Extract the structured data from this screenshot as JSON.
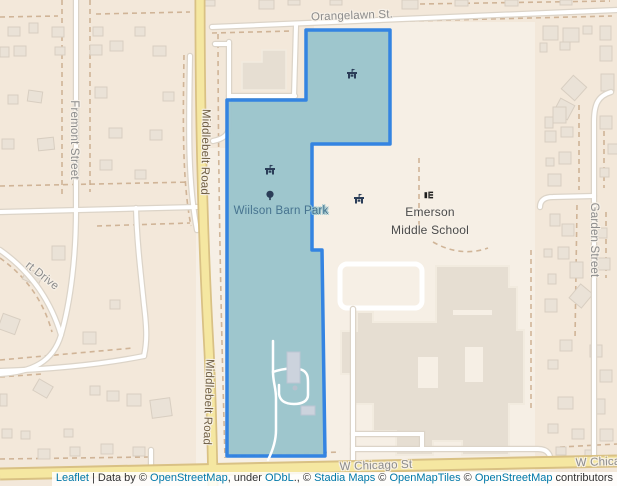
{
  "map": {
    "width": 617,
    "height": 486,
    "colors": {
      "base": "#f6efe5",
      "residential": "#f3e8da",
      "road_casing": "#dcd4c8",
      "road_fill": "#ffffff",
      "major_fill": "#f5e7a1",
      "major_casing": "#d9c184",
      "fence": "#c9aa8b",
      "house_fill": "#eae2d7",
      "house_stroke": "#d8cec1",
      "building_fill": "#e6ded2",
      "building_stroke": "#f2ebdf",
      "courtyard_fill": "#f6efe5",
      "park_fill": "#9cc5cd",
      "park_stroke": "#2e81e2",
      "barn_fill": "#ccd3dd",
      "icon_navy": "#2b3d58",
      "icon_black": "#1d1d1d",
      "label_gray": "#8c8c8c",
      "label_road_brown": "#6f5e44",
      "label_park": "#47738f",
      "label_poi": "#4a4a4a",
      "link_blue": "#0078a8"
    },
    "landuse": [
      {
        "x": 0,
        "y": 0,
        "w": 196,
        "h": 486
      },
      {
        "x": 196,
        "y": 0,
        "w": 118,
        "h": 148
      },
      {
        "x": 535,
        "y": 0,
        "w": 82,
        "h": 486
      },
      {
        "x": 314,
        "y": 0,
        "w": 221,
        "h": 22
      }
    ],
    "dashed_lines": [
      "M 62,0 L 62,198",
      "M 90,0 L 90,192",
      "M 0,186 L 192,182",
      "M 97,226 L 190,223",
      "M 0,17 L 58,16",
      "M 96,14 L 190,12",
      "M 184,55 C 183,120 182,180 191,226",
      "M 218,25 C 218,200 222,350 225,458",
      "M 212,33 L 293,31",
      "M 410,21 L 612,16",
      "M 420,4 L 610,1",
      "M 531,250 L 531,412",
      "M 419,158 L 419,237",
      "M 433,242 C 452,253 472,254 488,248",
      "M 579,105 L 579,190",
      "M 577,205 L 575,340",
      "M 604,122 L 604,188",
      "M 606,212 L 606,278",
      "M 0,360 L 133,348",
      "M 0,377 L 42,374",
      "M 0,258 C 28,278 44,303 52,332",
      "M 0,459 L 148,457",
      "M 232,456 L 340,452",
      "M 560,447 L 617,444"
    ],
    "houses": [
      [
        8,
        27,
        12,
        9,
        0
      ],
      [
        29,
        23,
        9,
        10,
        0
      ],
      [
        52,
        27,
        12,
        10,
        0
      ],
      [
        93,
        27,
        10,
        9,
        0
      ],
      [
        110,
        41,
        13,
        10,
        0
      ],
      [
        135,
        27,
        10,
        9,
        0
      ],
      [
        153,
        46,
        13,
        10,
        0
      ],
      [
        90,
        45,
        12,
        10,
        0
      ],
      [
        55,
        47,
        10,
        8,
        0
      ],
      [
        0,
        47,
        9,
        10,
        0
      ],
      [
        14,
        46,
        12,
        10,
        0
      ],
      [
        95,
        87,
        12,
        11,
        0
      ],
      [
        28,
        91,
        14,
        11,
        8
      ],
      [
        2,
        139,
        12,
        10,
        0
      ],
      [
        38,
        138,
        16,
        12,
        -6
      ],
      [
        109,
        128,
        13,
        10,
        0
      ],
      [
        150,
        130,
        12,
        10,
        0
      ],
      [
        100,
        160,
        12,
        10,
        0
      ],
      [
        135,
        170,
        11,
        9,
        0
      ],
      [
        163,
        92,
        11,
        9,
        0
      ],
      [
        8,
        95,
        10,
        9,
        0
      ],
      [
        52,
        246,
        13,
        14,
        0
      ],
      [
        24,
        271,
        17,
        12,
        25
      ],
      [
        0,
        316,
        18,
        16,
        20
      ],
      [
        83,
        332,
        13,
        12,
        0
      ],
      [
        110,
        300,
        10,
        9,
        0
      ],
      [
        35,
        382,
        16,
        13,
        30
      ],
      [
        90,
        386,
        10,
        9,
        0
      ],
      [
        107,
        391,
        12,
        10,
        0
      ],
      [
        127,
        394,
        14,
        12,
        0
      ],
      [
        151,
        399,
        20,
        18,
        -8
      ],
      [
        0,
        394,
        7,
        12,
        0
      ],
      [
        2,
        429,
        10,
        9,
        0
      ],
      [
        21,
        431,
        9,
        8,
        0
      ],
      [
        38,
        449,
        12,
        10,
        0
      ],
      [
        64,
        429,
        9,
        8,
        0
      ],
      [
        70,
        447,
        10,
        9,
        0
      ],
      [
        101,
        444,
        12,
        10,
        0
      ],
      [
        133,
        447,
        12,
        9,
        0
      ],
      [
        205,
        0,
        10,
        6,
        0
      ],
      [
        259,
        0,
        15,
        9,
        0
      ],
      [
        288,
        0,
        12,
        5,
        0
      ],
      [
        330,
        0,
        12,
        5,
        0
      ],
      [
        402,
        0,
        16,
        9,
        0
      ],
      [
        455,
        0,
        13,
        6,
        0
      ],
      [
        505,
        0,
        13,
        6,
        0
      ],
      [
        560,
        0,
        12,
        5,
        0
      ],
      [
        543,
        26,
        15,
        14,
        0
      ],
      [
        563,
        28,
        16,
        14,
        0
      ],
      [
        583,
        26,
        9,
        8,
        0
      ],
      [
        540,
        43,
        7,
        9,
        0
      ],
      [
        560,
        42,
        10,
        8,
        0
      ],
      [
        600,
        26,
        11,
        14,
        0
      ],
      [
        600,
        46,
        12,
        15,
        0
      ],
      [
        601,
        74,
        13,
        17,
        0
      ],
      [
        565,
        79,
        18,
        18,
        42
      ],
      [
        556,
        101,
        16,
        16,
        28
      ],
      [
        545,
        117,
        8,
        11,
        0
      ],
      [
        553,
        107,
        13,
        16,
        0
      ],
      [
        545,
        131,
        11,
        11,
        0
      ],
      [
        561,
        127,
        12,
        10,
        0
      ],
      [
        546,
        158,
        8,
        8,
        0
      ],
      [
        559,
        152,
        12,
        12,
        0
      ],
      [
        548,
        174,
        13,
        12,
        0
      ],
      [
        600,
        116,
        12,
        13,
        0
      ],
      [
        608,
        144,
        10,
        10,
        0
      ],
      [
        600,
        168,
        9,
        9,
        0
      ],
      [
        550,
        214,
        10,
        12,
        0
      ],
      [
        562,
        224,
        12,
        12,
        0
      ],
      [
        544,
        249,
        8,
        8,
        0
      ],
      [
        558,
        247,
        11,
        12,
        0
      ],
      [
        570,
        262,
        13,
        16,
        0
      ],
      [
        548,
        274,
        8,
        10,
        0
      ],
      [
        598,
        228,
        9,
        10,
        0
      ],
      [
        598,
        258,
        12,
        12,
        0
      ],
      [
        573,
        287,
        16,
        18,
        40
      ],
      [
        545,
        299,
        12,
        13,
        0
      ],
      [
        560,
        340,
        12,
        11,
        0
      ],
      [
        590,
        345,
        12,
        12,
        0
      ],
      [
        548,
        360,
        10,
        9,
        0
      ],
      [
        600,
        370,
        12,
        12,
        0
      ],
      [
        558,
        397,
        15,
        12,
        0
      ],
      [
        592,
        399,
        13,
        15,
        0
      ],
      [
        548,
        424,
        10,
        9,
        0
      ],
      [
        572,
        429,
        12,
        10,
        0
      ],
      [
        600,
        429,
        13,
        12,
        0
      ],
      [
        556,
        447,
        10,
        8,
        0
      ],
      [
        585,
        450,
        11,
        8,
        0
      ]
    ],
    "block_buildings": [
      "242,62 262,62 262,50 286,50 286,90 242,90"
    ],
    "school_building": {
      "outline": "436,266 509,266 509,287 517,287 517,330 524,330 524,404 509,404 509,455 462,455 462,441 433,441 433,455 396,455 396,431 373,431 373,404 352,404 352,374 341,374 341,331 357,331 357,312 373,312 373,322 436,322",
      "courtyards": [
        [
          418,
          357,
          20,
          31
        ],
        [
          465,
          347,
          18,
          35
        ],
        [
          453,
          310,
          39,
          5
        ]
      ]
    },
    "track": {
      "x": 340,
      "y": 264,
      "w": 82,
      "h": 44,
      "rx": 7
    },
    "roads_minor": [
      "M 212,27 L 617,10",
      "M 215,44 L 229,44",
      "M 229,42 L 229,126 C 229,135 223,139 213,141",
      "M 296,26 L 294,96",
      "M 229,96 L 295,96",
      "M 190,56 C 189,120 187,178 197,230",
      "M 0,212 L 197,207",
      "M 76,0 L 76,210",
      "M 76,210 C 76,255 71,300 61,335 C 53,362 32,372 0,374",
      "M 0,250 C 34,274 52,305 61,335",
      "M 136,208 C 137,244 141,275 144,305 C 147,330 147,342 144,356",
      "M 144,356 C 104,364 56,369 0,371",
      "M 151,450 L 151,470",
      "M 611,92 C 598,96 594,104 594,122 L 594,462",
      "M 540,207 C 540,200 545,197 553,197 L 594,196",
      "M 353,309 L 353,463",
      "M 353,434 L 422,434 L 422,449",
      "M 353,449 L 538,449 C 549,449 551,456 551,464"
    ],
    "roads_major": [
      "M 200,0 C 200,140 204,260 209,350 C 211,392 212,432 213,486",
      "M 0,474 L 617,461"
    ],
    "park": {
      "name": "Wiilson Barn Park",
      "outline": "306,30 390,30 390,144 312,144 312,250 322,250 325,456 227,456 227,100 306,100",
      "paths": [
        "M 273,341 L 273,372 C 273,382 276,388 276,398 L 276,430 C 276,442 272,452 268,460",
        "M 273,372 C 284,368 299,367 304,371 C 308,374 308,378 308,384 L 308,395 C 308,401 302,404 294,404 C 285,404 280,401 279,394 L 279,385"
      ],
      "barn_rects": [
        [
          287,
          352,
          13,
          31
        ],
        [
          301,
          406,
          14,
          9
        ]
      ],
      "dot": {
        "x": 295,
        "y": 388,
        "r": 2.5
      }
    },
    "icons": [
      {
        "type": "picnic-shelter",
        "x": 352,
        "y": 74
      },
      {
        "type": "picnic-shelter",
        "x": 270,
        "y": 170
      },
      {
        "type": "tree",
        "x": 270,
        "y": 196
      },
      {
        "type": "picnic-shelter",
        "x": 359,
        "y": 199
      },
      {
        "type": "school",
        "x": 429,
        "y": 195
      }
    ],
    "street_labels": [
      {
        "id": "orangelawn-st",
        "text": "Orangelawn St.",
        "x": 352,
        "y": 16,
        "rot": -2,
        "color": "gray",
        "size": 11.5
      },
      {
        "id": "fremont-street",
        "text": "Fremont Street",
        "x": 74,
        "y": 140,
        "rot": 90,
        "color": "gray",
        "size": 11.5
      },
      {
        "id": "middlebelt-road-north",
        "text": "Middlebelt Road",
        "x": 205,
        "y": 152,
        "rot": 91,
        "color": "brown",
        "size": 11.5
      },
      {
        "id": "middlebelt-road-south",
        "text": "Middlebelt Road",
        "x": 208,
        "y": 402,
        "rot": 92,
        "color": "brown",
        "size": 11.5
      },
      {
        "id": "garden-street",
        "text": "Garden Street",
        "x": 594,
        "y": 240,
        "rot": 90,
        "color": "gray",
        "size": 11.5
      },
      {
        "id": "rt-drive",
        "text": "rt Drive",
        "x": 42,
        "y": 276,
        "rot": 38,
        "color": "gray",
        "size": 11.5
      },
      {
        "id": "w-chicago-st-center",
        "text": "W Chicago St",
        "x": 376,
        "y": 466,
        "rot": -2,
        "color": "gray",
        "size": 11.5
      },
      {
        "id": "w-chicago-st-right",
        "text": "W Chicago St",
        "x": 612,
        "y": 462,
        "rot": -2,
        "color": "gray",
        "size": 11.5
      }
    ],
    "poi_labels": [
      {
        "id": "park-name",
        "text": "Wiilson Barn Park",
        "x": 281,
        "y": 211,
        "color": "park",
        "size": 11.5,
        "halo": "park"
      },
      {
        "id": "school-name-line1",
        "text": "Emerson",
        "x": 430,
        "y": 212,
        "color": "poi",
        "size": 12,
        "halo": "base"
      },
      {
        "id": "school-name-line2",
        "text": "Middle School",
        "x": 430,
        "y": 230,
        "color": "poi",
        "size": 12,
        "halo": "base"
      }
    ]
  },
  "attribution": {
    "parts": [
      {
        "text": "Leaflet",
        "link": true,
        "name": "attribution-link-leaflet"
      },
      {
        "text": " | Data by © ",
        "link": false,
        "name": "attribution-text"
      },
      {
        "text": "OpenStreetMap",
        "link": true,
        "name": "attribution-link-openstreetmap"
      },
      {
        "text": ", under ",
        "link": false,
        "name": "attribution-text"
      },
      {
        "text": "ODbL",
        "link": true,
        "name": "attribution-link-odbl"
      },
      {
        "text": "., © ",
        "link": false,
        "name": "attribution-text"
      },
      {
        "text": "Stadia Maps",
        "link": true,
        "name": "attribution-link-stadia-maps"
      },
      {
        "text": " © ",
        "link": false,
        "name": "attribution-text"
      },
      {
        "text": "OpenMapTiles",
        "link": true,
        "name": "attribution-link-openmaptiles"
      },
      {
        "text": " © ",
        "link": false,
        "name": "attribution-text"
      },
      {
        "text": "OpenStreetMap",
        "link": true,
        "name": "attribution-link-openstreetmap-2"
      },
      {
        "text": " contributors",
        "link": false,
        "name": "attribution-text"
      }
    ]
  }
}
